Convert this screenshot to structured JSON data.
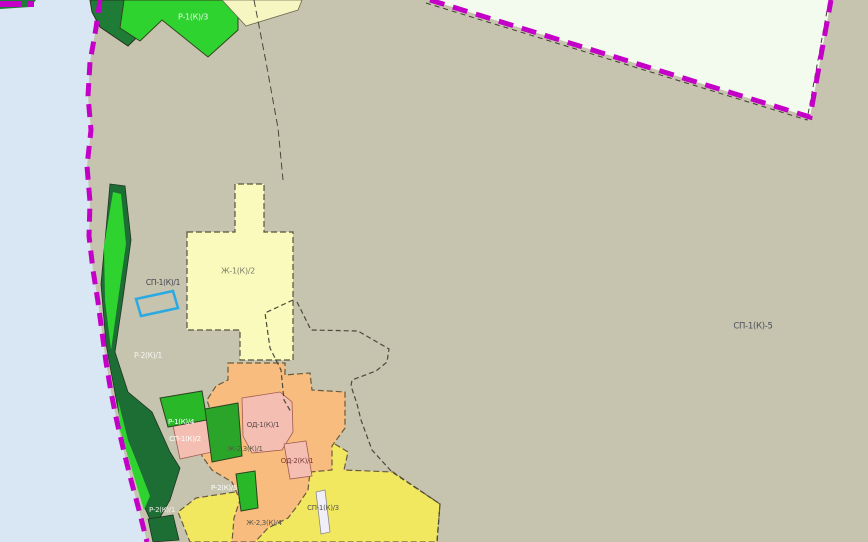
{
  "map": {
    "title": "zoning-map-viewport",
    "base_color": "#c6c4ae",
    "water_color": "#d9e6f3",
    "boundary_color": "#c400c8",
    "selection_color": "#2aa9e2",
    "regions": [
      {
        "name": "zone-water",
        "points": "0,0 100,0 96,28 90,62 88,96 91,130 87,166 90,202 89,236 93,270 98,302 102,332 106,362 111,392 117,422 124,452 131,480 139,510 147,542 0,542",
        "fill": "#d9e6f3",
        "stroke": "none",
        "sw": 0
      },
      {
        "name": "zone-pale-northeast",
        "points": "430,0 810,117 831,0",
        "fill": "#f3faee",
        "stroke": "none",
        "sw": 0
      },
      {
        "name": "zone-darkgreen-north",
        "points": "90,0 134,0 155,20 128,46 100,27 92,12",
        "fill": "#1e7c36",
        "stroke": "#28331f",
        "sw": 1
      },
      {
        "name": "zone-green-north",
        "points": "124,0 238,0 238,30 208,57 162,20 140,41 120,28",
        "fill": "#2fd32f",
        "stroke": "#33431f",
        "sw": 1
      },
      {
        "name": "zone-cream-north",
        "points": "222,0 302,0 298,10 246,26",
        "fill": "#f6f6c2",
        "stroke": "#6b6a50",
        "sw": 0.8
      },
      {
        "name": "boundary-sliver-corner",
        "points": "0,0 36,0 30,7 0,9",
        "fill": "#1e7c36",
        "stroke": "none",
        "sw": 0
      },
      {
        "name": "zone-yellow-mid",
        "points": "187,232 235,232 235,184 264,184 264,232 293,232 293,360 240,360 240,330 187,330",
        "fill": "#fafabc",
        "stroke": "#55543e",
        "sw": 1.2,
        "dash": "6 3"
      },
      {
        "name": "zone-yellow-bottom",
        "points": "312,430 348,452 344,470 393,472 440,504 437,542 190,542 178,512 196,498 235,492 262,487 287,505 300,488 306,470 309,452",
        "fill": "#f2e860",
        "stroke": "#6b5a3c",
        "sw": 1.2,
        "dash": "6 3"
      },
      {
        "name": "zone-coast-strip",
        "points": "110,184 125,186 131,240 123,298 115,352 128,392 152,412 170,452 180,468 170,500 154,528 144,506 128,454 117,404 106,344 101,284 106,230",
        "fill": "#1d6e35",
        "stroke": "#203321",
        "sw": 0.8
      },
      {
        "name": "coast-stripe-bright-1",
        "points": "113,192 121,194 126,244 118,300 111,350 105,300 104,246",
        "fill": "#2fd32f",
        "stroke": "none",
        "sw": 0
      },
      {
        "name": "coast-stripe-bright-2",
        "points": "118,400 128,440 140,470 150,496 144,510 132,470 120,430",
        "fill": "#2fd32f",
        "stroke": "none",
        "sw": 0
      },
      {
        "name": "zone-orange",
        "points": "228,363 285,363 285,375 310,373 312,390 345,392 345,428 332,446 332,470 310,472 308,490 298,505 288,518 268,528 255,542 232,542 234,518 240,500 232,482 212,470 202,456 200,432 212,416 207,400 216,386 228,380",
        "fill": "#f8bd7e",
        "stroke": "#6b5a3c",
        "sw": 1.2,
        "dash": "6 3"
      },
      {
        "name": "zone-pink-west",
        "points": "172,421 206,414 212,452 180,459",
        "fill": "#f4bfb2",
        "stroke": "#a05c50",
        "sw": 0.8
      },
      {
        "name": "zone-green-patch-upper",
        "points": "160,398 202,391 207,420 168,427",
        "fill": "#28b828",
        "stroke": "#2c4320",
        "sw": 1
      },
      {
        "name": "zone-green-patch-main",
        "points": "205,409 238,403 242,456 212,462",
        "fill": "#2aa52a",
        "stroke": "#2c4320",
        "sw": 1
      },
      {
        "name": "zone-pink-od1",
        "points": "242,398 280,392 292,402 293,432 282,450 252,453 243,436",
        "fill": "#f4bfb2",
        "stroke": "#a05c50",
        "sw": 0.8
      },
      {
        "name": "zone-pink-od2",
        "points": "284,444 306,441 312,476 290,479",
        "fill": "#f4bfb2",
        "stroke": "#a05c50",
        "sw": 0.8
      },
      {
        "name": "zone-green-patch-south",
        "points": "236,474 255,471 258,508 241,511",
        "fill": "#28b828",
        "stroke": "#2c4320",
        "sw": 1
      },
      {
        "name": "zone-darkgreen-bottom",
        "points": "148,519 173,515 179,540 153,542",
        "fill": "#1d6e35",
        "stroke": "#203321",
        "sw": 0.8
      },
      {
        "name": "zone-white-strip",
        "points": "316,492 325,490 330,532 321,534",
        "fill": "#f0eef8",
        "stroke": "#8a8a8a",
        "sw": 0.8
      }
    ],
    "lines": [
      {
        "name": "boundary-black-northeast",
        "points": "426,3 807,120 829,0",
        "color": "#3c3c30",
        "width": 1,
        "dash": "5 4"
      },
      {
        "name": "boundary-municipal-north",
        "points": "254,0 266,62 278,128 283,180",
        "color": "#4a4a3a",
        "width": 1,
        "dash": "7 4"
      },
      {
        "name": "boundary-corridor-west",
        "points": "293,300 265,313 270,348 281,370 284,400 291,412",
        "color": "#4a4a3a",
        "width": 1.2,
        "dash": "5 3"
      },
      {
        "name": "boundary-corridor-east",
        "points": "297,302 311,330 358,331 389,349 387,362 376,371 352,380 351,386 357,404 361,420 372,450 392,472 440,504 437,542",
        "color": "#4a4a3a",
        "width": 1.2,
        "dash": "5 3"
      },
      {
        "name": "boundary-magenta-coast",
        "points": "100,0 96,28 90,62 88,96 91,130 87,166 90,202 89,236 93,270 98,302 102,332 106,362 111,392 117,422 124,452 131,480 139,510 147,542",
        "color": "#c400c8",
        "width": 5,
        "dash": "13 8"
      },
      {
        "name": "boundary-magenta-corner",
        "points": "0,4 34,4",
        "color": "#c400c8",
        "width": 6,
        "dash": "22 6"
      },
      {
        "name": "boundary-magenta-northeast",
        "points": "430,0 810,117 831,0",
        "color": "#c400c8",
        "width": 5,
        "dash": "15 9"
      }
    ],
    "labels": [
      {
        "name": "zone-label-r1k3",
        "text": "Р-1(К)/3",
        "x": 193,
        "y": 17,
        "color": "#e9f7e4",
        "size": 8
      },
      {
        "name": "zone-label-zh1k2",
        "text": "Ж-1(К)/2",
        "x": 238,
        "y": 271,
        "color": "#7d7d6d",
        "size": 8
      },
      {
        "name": "zone-label-sp1k1",
        "text": "СП-1(К)/1",
        "x": 163,
        "y": 283,
        "color": "#3f4150",
        "size": 7.5
      },
      {
        "name": "zone-label-r2k1-upper",
        "text": "Р-2(К)/1",
        "x": 148,
        "y": 356,
        "color": "#f5f5ef",
        "size": 7.5
      },
      {
        "name": "zone-label-sp1k5",
        "text": "СП-1(К)-5",
        "x": 753,
        "y": 326,
        "color": "#4d505c",
        "size": 8.5
      },
      {
        "name": "zone-label-r1k4",
        "text": "Р-1(К)/4",
        "x": 181,
        "y": 422,
        "color": "#ffffff",
        "size": 7
      },
      {
        "name": "zone-label-sp1k2",
        "text": "СП-1(К)/2",
        "x": 185,
        "y": 439,
        "color": "#ffffff",
        "size": 7
      },
      {
        "name": "zone-label-od1k1",
        "text": "ОД-1(К)/1",
        "x": 263,
        "y": 425,
        "color": "#584848",
        "size": 7
      },
      {
        "name": "zone-label-zh23k1",
        "text": "Ж-2,3(К)/1",
        "x": 245,
        "y": 449,
        "color": "#5a5a48",
        "size": 7
      },
      {
        "name": "zone-label-od2k1",
        "text": "ОД-2(К)/1",
        "x": 297,
        "y": 461,
        "color": "#7c3a3a",
        "size": 7
      },
      {
        "name": "zone-label-r2k5",
        "text": "Р-2(К)/5",
        "x": 224,
        "y": 488,
        "color": "#ffffff",
        "size": 7
      },
      {
        "name": "zone-label-r2k1-lower",
        "text": "Р-2(К)/1",
        "x": 162,
        "y": 510,
        "color": "#f2f2ea",
        "size": 7
      },
      {
        "name": "zone-label-sp1k3",
        "text": "СП-1(К)/3",
        "x": 323,
        "y": 508,
        "color": "#55554a",
        "size": 7
      },
      {
        "name": "zone-label-zh23k4",
        "text": "Ж-2,3(К)/4",
        "x": 264,
        "y": 523,
        "color": "#55554a",
        "size": 7
      }
    ],
    "selection": {
      "name": "selected-parcel-rectangle",
      "points": "136,299 173,291 178,308 141,316",
      "color": "#2aa9e2",
      "width": 2.5
    }
  }
}
